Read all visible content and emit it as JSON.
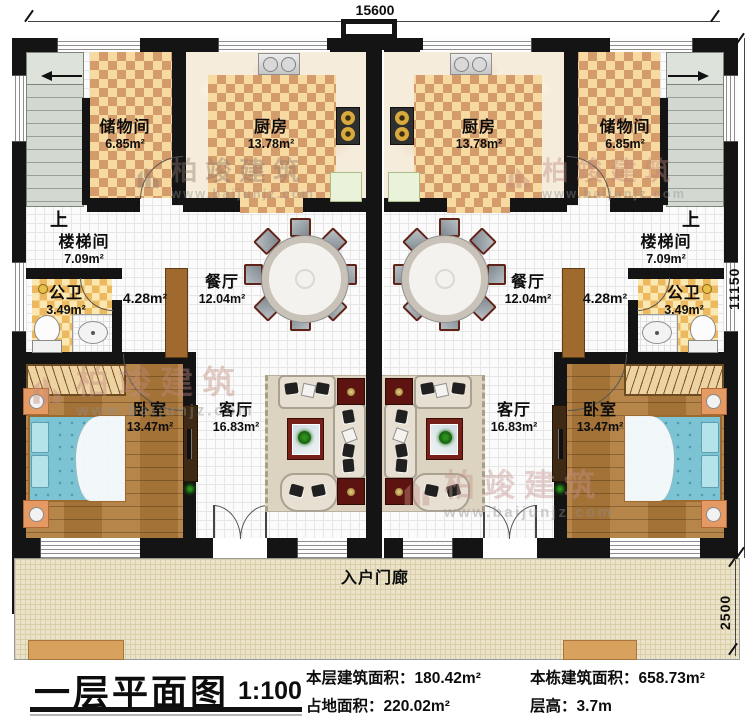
{
  "dimensions": {
    "top": "15600",
    "right": "11150",
    "porch": "2500"
  },
  "unit_rooms": {
    "storage": {
      "name": "储物间",
      "area": "6.85m²"
    },
    "kitchen": {
      "name": "厨房",
      "area": "13.78m²"
    },
    "stairwell": {
      "name": "楼梯间",
      "area": "7.09m²"
    },
    "stairs_up": "上",
    "bathroom": {
      "name": "公卫",
      "area": "3.49m²"
    },
    "corridor": {
      "area": "4.28m²"
    },
    "dining": {
      "name": "餐厅",
      "area": "12.04m²"
    },
    "bedroom": {
      "name": "卧室",
      "area": "13.47m²"
    },
    "living": {
      "name": "客厅",
      "area": "16.83m²"
    }
  },
  "porch": {
    "name": "入户门廊"
  },
  "titleblock": {
    "title": "一层平面图",
    "scale": "1:100",
    "stats": [
      {
        "label": "本层建筑面积：",
        "value": "180.42m²"
      },
      {
        "label": "占地面积：",
        "value": "220.02m²"
      },
      {
        "label": "本栋建筑面积：",
        "value": "658.73m²"
      },
      {
        "label": "层高：",
        "value": "3.7m"
      }
    ]
  },
  "watermark": {
    "brand": "柏竣建筑",
    "url": "www.baijunjz.com"
  },
  "colors": {
    "wall": "#141414",
    "tile_light": "#f7d9a2",
    "tile_dark": "#d49c6b",
    "bath_tile": "#ecb95f",
    "wood": "#b07c3c",
    "bed_blue": "#7cc4d4",
    "rug_red": "#5d1410",
    "porch": "#ebe3c9",
    "stairs": "#d3d9d1"
  }
}
